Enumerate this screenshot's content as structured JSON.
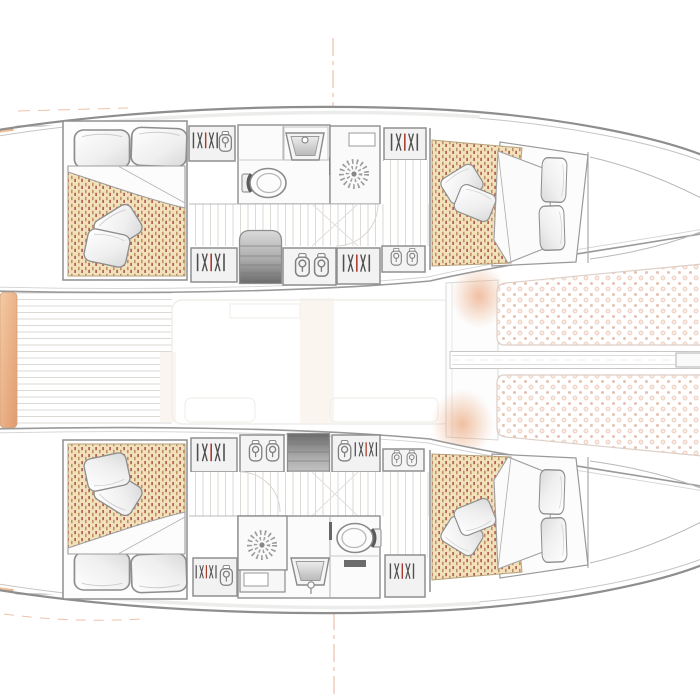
{
  "meta": {
    "description": "sailing-catamaran-deck-and-accommodation-plan",
    "orientation": "bow-right"
  },
  "colors": {
    "background": "#ffffff",
    "hull_line": "#8e8e8e",
    "hull_line_soft": "#c6c6c6",
    "wall_line": "#8f8f8f",
    "mattress_base": "#f1e1bd",
    "mattress_dash_brown": "#bf9161",
    "mattress_dash_red": "#ad5847",
    "mattress_edge": "#b7a27a",
    "net_dot": "#f0d7ca",
    "net_dot_small": "#e6c2b0",
    "net_edge": "#ddcfc6",
    "cushion_light": "#f4cba4",
    "cushion_dark": "#e19a6e",
    "glow": "#e89e6f",
    "pillow_shade": "#d9d9d9",
    "stair_light": "#dadada",
    "stair_dark": "#6a6a6a",
    "plank": "#ddd9d4",
    "hanger_stroke": "#4f4f4f",
    "hanger_accent": "#a83b2c",
    "fixture_stroke": "#8a8a8a",
    "accent_dash": "#edc2aa"
  },
  "legend": {
    "hull_count": 2,
    "double_berth_count": 4,
    "head_compartments": 2,
    "shower_drains": 2,
    "companionway_stairs": 2,
    "trampoline_panels": 2
  },
  "icons": [
    "wardrobe-hanger-icon",
    "garment-on-hanger-icon",
    "shower-drain-icon",
    "toilet-icon",
    "sink-icon",
    "staircase-icon",
    "pillow-shape",
    "mattress-pattern",
    "trampoline-net-pattern"
  ]
}
